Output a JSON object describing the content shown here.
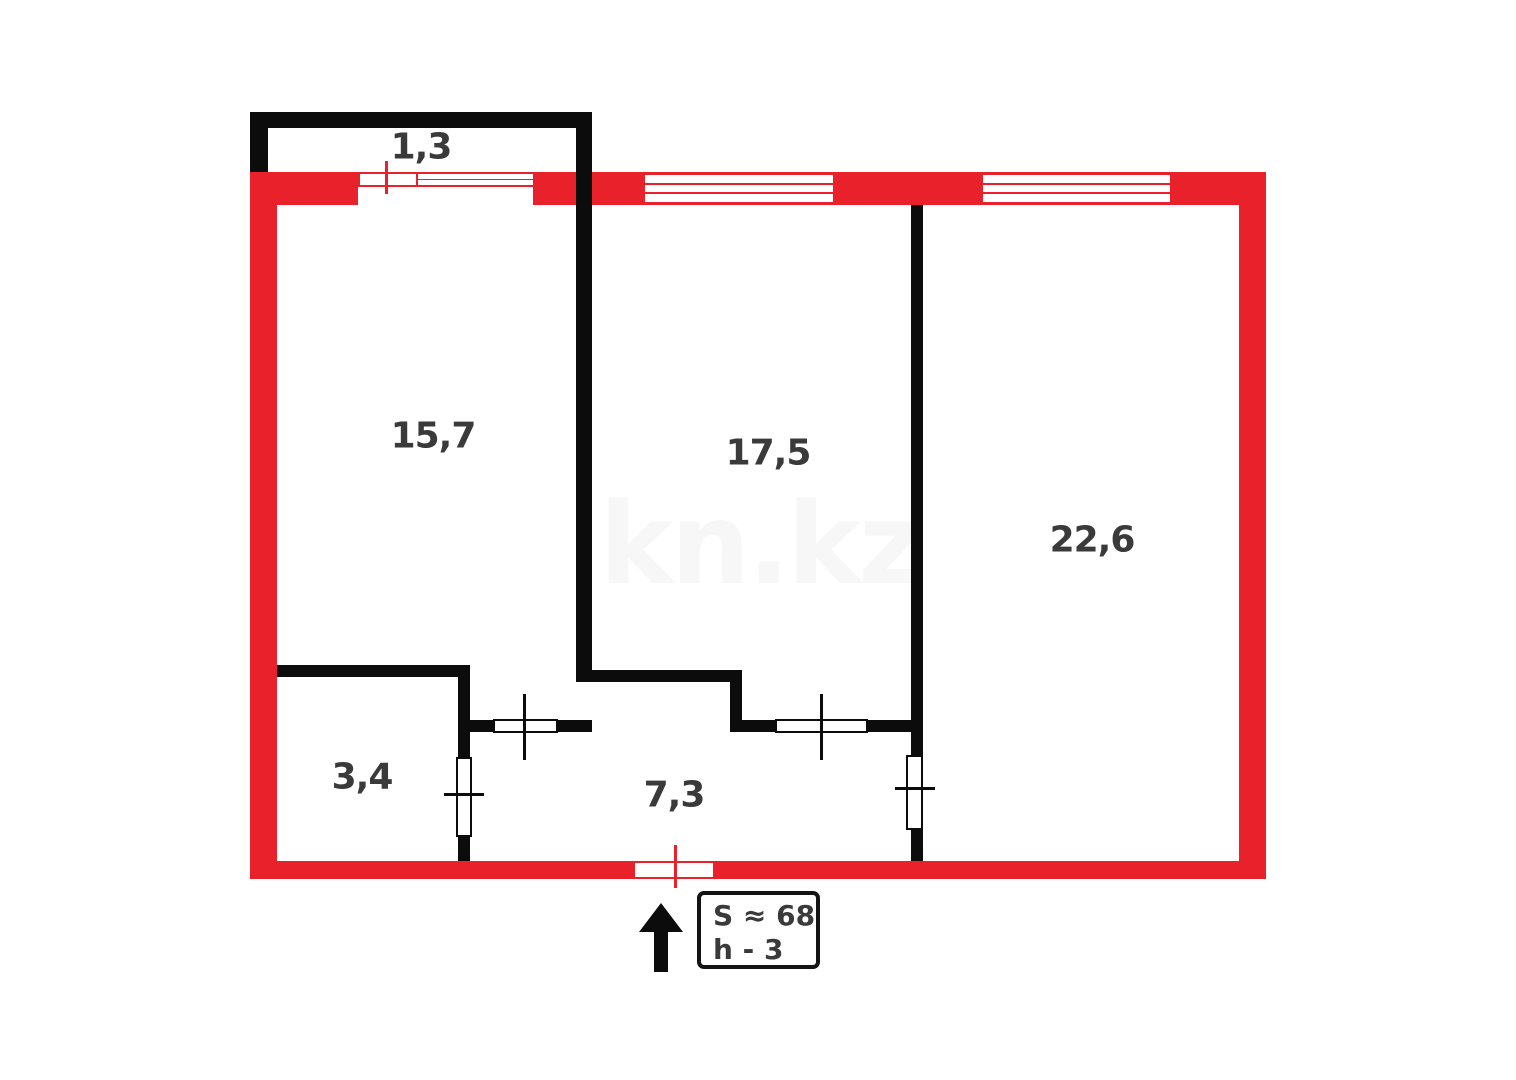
{
  "floorplan": {
    "watermark": "kn.kz",
    "labels": {
      "balcony": "1,3",
      "room_left": "15,7",
      "room_middle": "17,5",
      "room_right": "22,6",
      "room_small": "3,4",
      "hallway": "7,3"
    },
    "info_box": {
      "area_line": "S ≈ 68",
      "height_line": "h - 3"
    },
    "colors": {
      "outer_wall": "#e9212a",
      "inner_wall": "#0c0c0c",
      "label_text": "#3a3a3a",
      "watermark_text": "#f7f7f7"
    }
  }
}
